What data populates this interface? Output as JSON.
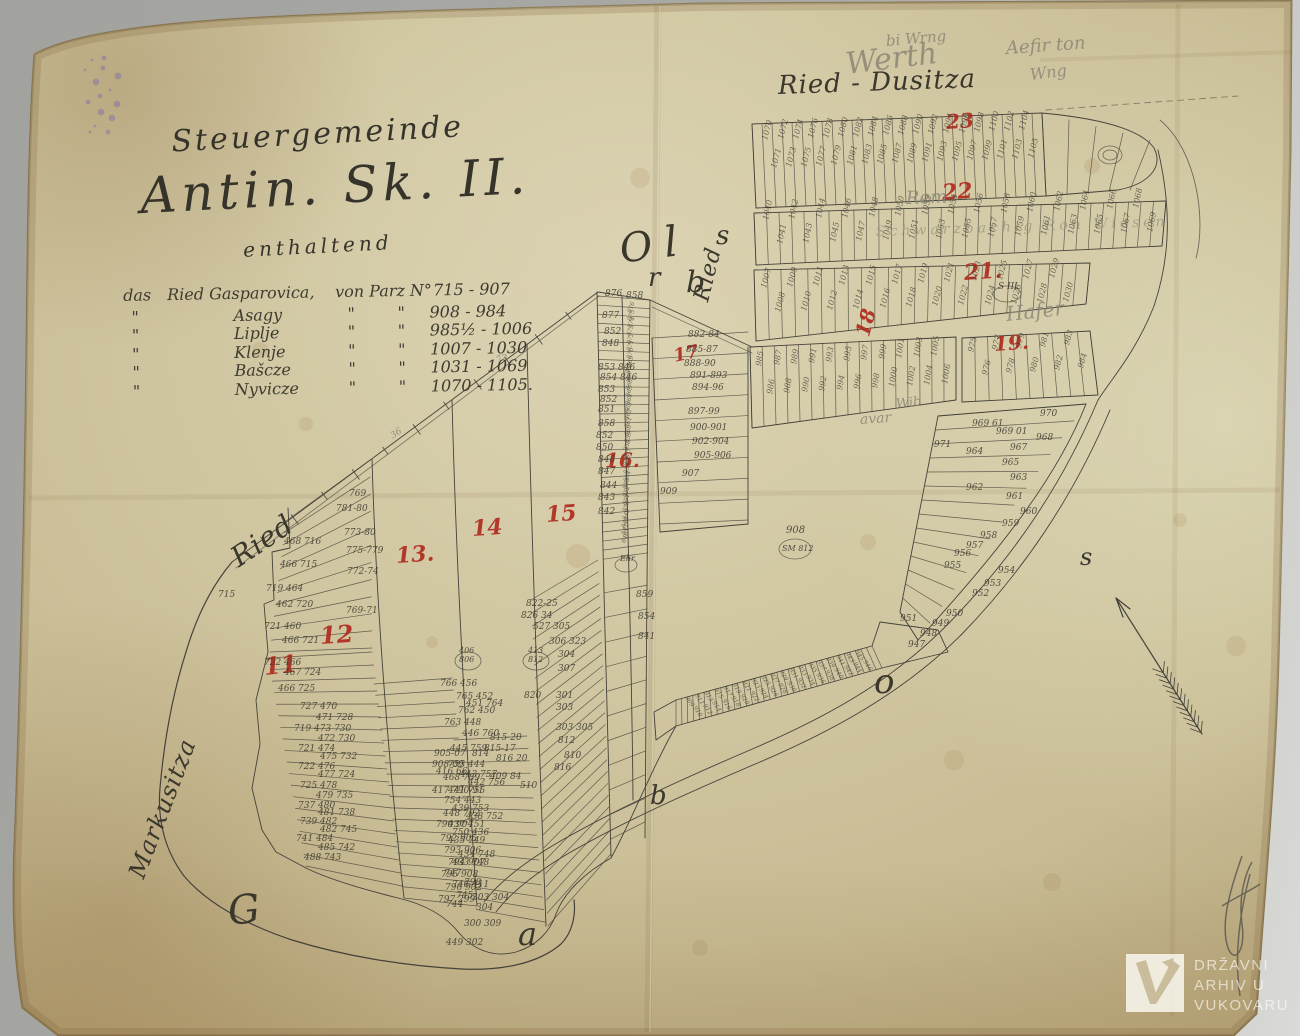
{
  "heading": {
    "line1": "Steuergemeinde",
    "line2": "Antin. Sk. II.",
    "subtitle": "enthaltend"
  },
  "legend": {
    "intro": {
      "c1": "das",
      "c2": "Ried Gasparovica,",
      "c3": "von Parz N°",
      "range": "715 - 907"
    },
    "rows": [
      {
        "c1": "\"",
        "name": "Asagy",
        "d1": "\"",
        "d2": "\"",
        "range": "908 - 984"
      },
      {
        "c1": "\"",
        "name": "Liplje",
        "d1": "\"",
        "d2": "\"",
        "range": "985½ - 1006"
      },
      {
        "c1": "\"",
        "name": "Klenje",
        "d1": "\"",
        "d2": "\"",
        "range": "1007 - 1030"
      },
      {
        "c1": "\"",
        "name": "Bašcze",
        "d1": "\"",
        "d2": "\"",
        "range": "1031 - 1069"
      },
      {
        "c1": "\"",
        "name": "Nyvicze",
        "d1": "\"",
        "d2": "\"",
        "range": "1070 - 1105."
      }
    ]
  },
  "watermark": {
    "line1": "DRŽAVNI",
    "line2": "ARHIV U",
    "line3": "VUKOVARU"
  },
  "map": {
    "colors": {
      "paper": "#d0c6a1",
      "ink": "#45423a",
      "red": "#b02c20",
      "pencil": "#8b8676",
      "scanner_grey": "#a9a9a5"
    },
    "labels": {
      "fields": [
        "text",
        "x",
        "y",
        "size",
        "rot",
        "class"
      ],
      "items": [
        [
          "Ried - Dusitza",
          778,
          94,
          26,
          -2,
          "s"
        ],
        [
          "Ried",
          702,
          308,
          22,
          -76,
          "s"
        ],
        [
          "Ried",
          234,
          568,
          28,
          -34,
          "s"
        ],
        [
          "Markusitza",
          136,
          884,
          24,
          -69,
          "s"
        ],
        [
          "O",
          620,
          262,
          40,
          -8,
          "s"
        ],
        [
          "r",
          648,
          286,
          26,
          0,
          "s"
        ],
        [
          "l",
          664,
          256,
          42,
          -6,
          "s"
        ],
        [
          "s",
          716,
          244,
          26,
          0,
          "s"
        ],
        [
          "b",
          686,
          292,
          30,
          0,
          "s"
        ],
        [
          "b",
          650,
          804,
          26,
          0,
          "s"
        ],
        [
          "o",
          874,
          692,
          34,
          0,
          "s"
        ],
        [
          "s",
          1080,
          564,
          24,
          0,
          "s"
        ],
        [
          "G",
          228,
          924,
          40,
          -6,
          "s"
        ],
        [
          "a",
          518,
          944,
          32,
          0,
          "s"
        ],
        [
          "11",
          264,
          674,
          24,
          -6,
          "r"
        ],
        [
          "12",
          320,
          643,
          24,
          -4,
          "r"
        ],
        [
          "13.",
          396,
          563,
          22,
          -4,
          "r"
        ],
        [
          "14",
          472,
          536,
          22,
          -4,
          "r"
        ],
        [
          "15",
          546,
          522,
          22,
          -4,
          "r"
        ],
        [
          "16.",
          605,
          466,
          20,
          0,
          "r"
        ],
        [
          "17",
          674,
          362,
          18,
          -12,
          "r"
        ],
        [
          "18",
          862,
          342,
          20,
          -75,
          "r"
        ],
        [
          "19.",
          994,
          350,
          20,
          -4,
          "r"
        ],
        [
          "21.",
          964,
          280,
          22,
          -4,
          "r"
        ],
        [
          "22",
          942,
          200,
          22,
          -4,
          "r"
        ],
        [
          "23",
          946,
          128,
          20,
          -4,
          "r"
        ],
        [
          "Werth",
          846,
          74,
          30,
          -7,
          "p"
        ],
        [
          "bi Wrng",
          886,
          46,
          15,
          -5,
          "p"
        ],
        [
          "Aefir ton",
          1006,
          54,
          18,
          -4,
          "p"
        ],
        [
          "Wng",
          1030,
          80,
          16,
          -7,
          "p"
        ],
        [
          "Rem",
          906,
          204,
          18,
          -2,
          "p"
        ],
        [
          "Schwarzbachig Ron Wiesen",
          876,
          236,
          14,
          -2,
          "p2"
        ],
        [
          "Hafer",
          1006,
          320,
          20,
          -6,
          "p"
        ],
        [
          "avar",
          860,
          424,
          14,
          -4,
          "p"
        ],
        [
          "Wib",
          896,
          408,
          13,
          -6,
          "p"
        ],
        [
          "36",
          392,
          440,
          9,
          -34,
          "p"
        ],
        [
          "75",
          498,
          364,
          9,
          -34,
          "p"
        ],
        [
          "769",
          349,
          497
        ],
        [
          "781-80",
          336,
          512
        ],
        [
          "773-80",
          344,
          536
        ],
        [
          "775-779",
          346,
          554
        ],
        [
          "772-74",
          347,
          575
        ],
        [
          "769-71",
          346,
          614
        ],
        [
          "715",
          218,
          598
        ],
        [
          "468 716",
          284,
          545
        ],
        [
          "466 715",
          280,
          568
        ],
        [
          "719 464",
          266,
          592
        ],
        [
          "462 720",
          276,
          608
        ],
        [
          "721 460",
          264,
          630
        ],
        [
          "466 721",
          282,
          644
        ],
        [
          "722 466",
          264,
          666
        ],
        [
          "467 724",
          284,
          676
        ],
        [
          "466 725",
          278,
          692
        ],
        [
          "727 470",
          300,
          710
        ],
        [
          "471 728",
          316,
          721
        ],
        [
          "719 473 730",
          294,
          732
        ],
        [
          "472 730",
          318,
          742
        ],
        [
          "721 474",
          298,
          752
        ],
        [
          "475 732",
          320,
          760
        ],
        [
          "722 476",
          298,
          770
        ],
        [
          "477 724",
          318,
          778
        ],
        [
          "725 478",
          300,
          789
        ],
        [
          "479 735",
          316,
          799
        ],
        [
          "737 480",
          298,
          809
        ],
        [
          "481 738",
          318,
          816
        ],
        [
          "739 482",
          300,
          825
        ],
        [
          "482 745",
          320,
          833
        ],
        [
          "741 484",
          296,
          842
        ],
        [
          "485 742",
          318,
          851
        ],
        [
          "488 743",
          304,
          861
        ],
        [
          "766 456",
          440,
          687
        ],
        [
          "765 452",
          456,
          700
        ],
        [
          "451 764",
          466,
          707
        ],
        [
          "762 450",
          458,
          714
        ],
        [
          "763 448",
          444,
          726
        ],
        [
          "446 760",
          462,
          737
        ],
        [
          "445 759",
          450,
          752
        ],
        [
          "753 444",
          448,
          768
        ],
        [
          "443 757",
          460,
          778
        ],
        [
          "442 756",
          468,
          786
        ],
        [
          "441 755",
          448,
          794
        ],
        [
          "754 443",
          444,
          804
        ],
        [
          "439 753",
          452,
          812
        ],
        [
          "438 752",
          466,
          820
        ],
        [
          "437 751",
          448,
          828
        ],
        [
          "750 436",
          452,
          836
        ],
        [
          "435 749",
          448,
          844
        ],
        [
          "434 748",
          458,
          858
        ],
        [
          "433 748",
          452,
          866
        ],
        [
          "747",
          444,
          877
        ],
        [
          "746 411",
          452,
          888
        ],
        [
          "745",
          456,
          899
        ],
        [
          "744",
          446,
          908
        ],
        [
          "905-07",
          434,
          757
        ],
        [
          "908-09",
          432,
          768
        ],
        [
          "416 66",
          436,
          775
        ],
        [
          "468 789",
          443,
          781
        ],
        [
          "417 790-91",
          432,
          794
        ],
        [
          "448 792",
          443,
          817
        ],
        [
          "790 904",
          436,
          828
        ],
        [
          "792 905",
          440,
          842
        ],
        [
          "793 906",
          444,
          854
        ],
        [
          "794 907",
          448,
          866
        ],
        [
          "795 908",
          441,
          878
        ],
        [
          "796 902",
          445,
          891
        ],
        [
          "798",
          464,
          886
        ],
        [
          "797 299",
          438,
          903
        ],
        [
          "303 304",
          472,
          901
        ],
        [
          "300 309",
          464,
          927
        ],
        [
          "449 302",
          446,
          946
        ],
        [
          "304",
          476,
          911
        ],
        [
          "822-25",
          526,
          607
        ],
        [
          "826 34",
          521,
          619
        ],
        [
          "527 305",
          533,
          630
        ],
        [
          "306 323",
          549,
          645
        ],
        [
          "304",
          558,
          658
        ],
        [
          "307",
          558,
          672
        ],
        [
          "820",
          524,
          699
        ],
        [
          "301",
          556,
          699
        ],
        [
          "303",
          556,
          711
        ],
        [
          "303 305",
          556,
          731
        ],
        [
          "815-20",
          490,
          741
        ],
        [
          "815-17",
          484,
          752
        ],
        [
          "816 20",
          496,
          762
        ],
        [
          "409 84",
          490,
          780
        ],
        [
          "510",
          520,
          789
        ],
        [
          "812",
          558,
          744
        ],
        [
          "810",
          564,
          759
        ],
        [
          "816",
          554,
          771
        ],
        [
          "814",
          472,
          757
        ],
        [
          "876",
          605,
          297
        ],
        [
          "858",
          626,
          299
        ],
        [
          "877",
          602,
          319
        ],
        [
          "852",
          604,
          335
        ],
        [
          "848",
          602,
          347
        ],
        [
          "853 846",
          598,
          371
        ],
        [
          "854 846",
          600,
          381
        ],
        [
          "853",
          598,
          393
        ],
        [
          "852",
          600,
          403
        ],
        [
          "851",
          598,
          413
        ],
        [
          "858",
          598,
          427
        ],
        [
          "852",
          596,
          439
        ],
        [
          "850",
          596,
          451
        ],
        [
          "848",
          598,
          463
        ],
        [
          "847",
          598,
          475
        ],
        [
          "844",
          600,
          489
        ],
        [
          "843",
          598,
          501
        ],
        [
          "842",
          598,
          515
        ],
        [
          "882-84",
          688,
          338
        ],
        [
          "885-87",
          686,
          353
        ],
        [
          "888-90",
          684,
          367
        ],
        [
          "891-893",
          690,
          379
        ],
        [
          "894-96",
          692,
          391
        ],
        [
          "897-99",
          688,
          415
        ],
        [
          "900-901",
          690,
          431
        ],
        [
          "902-904",
          692,
          445
        ],
        [
          "905-906",
          694,
          459
        ],
        [
          "907",
          682,
          477
        ],
        [
          "909",
          660,
          495
        ],
        [
          "859",
          636,
          598
        ],
        [
          "854",
          638,
          620
        ],
        [
          "841",
          638,
          640
        ],
        [
          "908",
          786,
          534,
          10
        ],
        [
          "SM 812",
          782,
          551,
          8
        ],
        [
          "406",
          459,
          653,
          8
        ],
        [
          "806",
          459,
          662,
          8
        ],
        [
          "413",
          528,
          653,
          8
        ],
        [
          "812",
          528,
          662,
          8
        ],
        [
          "Ehr",
          620,
          561,
          8
        ],
        [
          "S III",
          998,
          290,
          9
        ],
        [
          "971",
          934,
          448
        ],
        [
          "970",
          1040,
          417
        ],
        [
          "969 61",
          972,
          427
        ],
        [
          "969 01",
          996,
          435
        ],
        [
          "968",
          1036,
          441
        ],
        [
          "967",
          1010,
          451
        ],
        [
          "965",
          1002,
          466
        ],
        [
          "964",
          966,
          455
        ],
        [
          "963",
          1010,
          481
        ],
        [
          "962",
          966,
          491
        ],
        [
          "961",
          1006,
          500
        ],
        [
          "960",
          1020,
          515
        ],
        [
          "959",
          1002,
          527
        ],
        [
          "958",
          980,
          539
        ],
        [
          "957",
          966,
          549
        ],
        [
          "956",
          954,
          557
        ],
        [
          "955",
          944,
          569
        ],
        [
          "954",
          998,
          574
        ],
        [
          "953",
          984,
          587
        ],
        [
          "952",
          972,
          597
        ],
        [
          "951",
          900,
          622
        ],
        [
          "950",
          946,
          617
        ],
        [
          "949",
          932,
          627
        ],
        [
          "948",
          920,
          637
        ],
        [
          "947",
          908,
          648
        ]
      ]
    },
    "texture_blocks": [
      [
        1070,
        1105,
        766,
        150,
        1030,
        140,
        -75,
        8,
        14
      ],
      [
        1040,
        1069,
        766,
        228,
        1150,
        216,
        -78,
        8,
        12
      ],
      [
        1007,
        1030,
        764,
        296,
        1066,
        286,
        -75,
        8,
        12
      ],
      [
        985,
        1006,
        760,
        376,
        944,
        366,
        -80,
        8,
        14
      ],
      [
        975,
        984,
        972,
        360,
        1080,
        352,
        -75,
        8,
        12
      ],
      [
        846,
        876,
        624,
        540,
        630,
        310,
        -70,
        6,
        0
      ],
      [
        909,
        946,
        688,
        700,
        862,
        652,
        58,
        6,
        6
      ]
    ]
  }
}
